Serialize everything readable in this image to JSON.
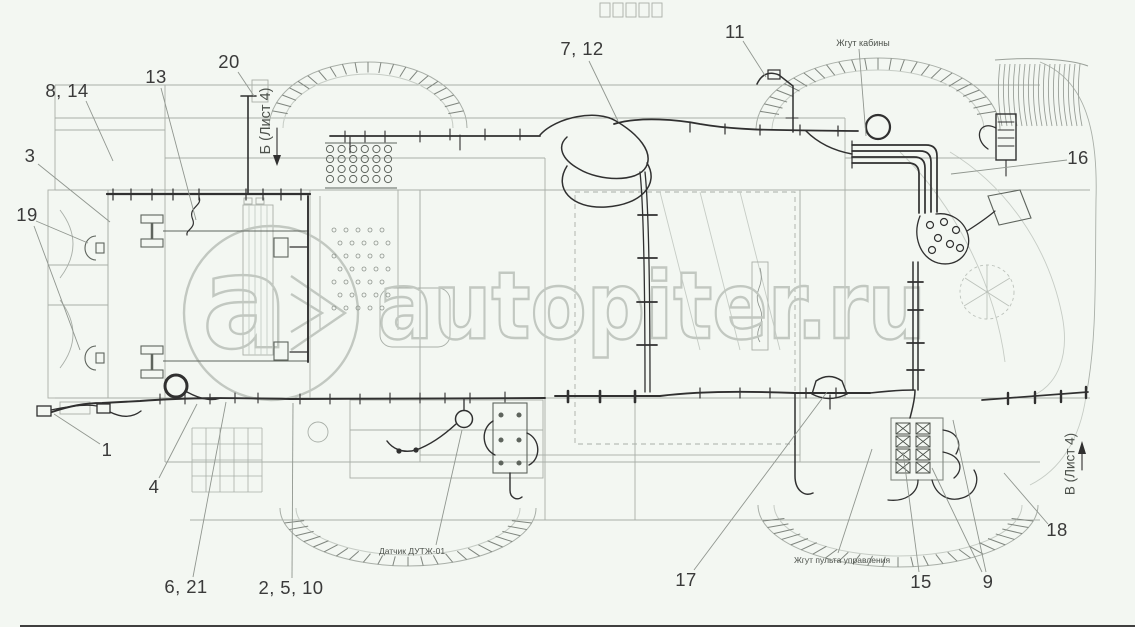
{
  "page": {
    "background": "#f3f7f2",
    "bottom_rule_color": "#3f3f3f"
  },
  "watermark": {
    "logo_letter": "a",
    "text": "autopiter.ru",
    "color": "#c2c8c1"
  },
  "drawing": {
    "dark_line_color": "#303030",
    "light_line_color": "#a9afa8",
    "leader_color": "#90968f",
    "callout_color": "#3a3a3a",
    "callouts": [
      {
        "label": "8, 14",
        "x": 67,
        "y": 91,
        "leaders": [
          [
            86,
            101,
            113,
            161
          ]
        ]
      },
      {
        "label": "13",
        "x": 156,
        "y": 77,
        "leaders": [
          [
            161,
            88,
            196,
            220
          ]
        ]
      },
      {
        "label": "20",
        "x": 229,
        "y": 62,
        "leaders": [
          [
            238,
            72,
            254,
            96
          ]
        ]
      },
      {
        "label": "3",
        "x": 30,
        "y": 156,
        "leaders": [
          [
            38,
            164,
            110,
            222
          ]
        ]
      },
      {
        "label": "19",
        "x": 27,
        "y": 215,
        "leaders": [
          [
            36,
            221,
            88,
            243
          ],
          [
            34,
            226,
            80,
            350
          ]
        ]
      },
      {
        "label": "1",
        "x": 107,
        "y": 450,
        "leaders": [
          [
            100,
            444,
            54,
            414
          ]
        ]
      },
      {
        "label": "4",
        "x": 154,
        "y": 487,
        "leaders": [
          [
            159,
            478,
            197,
            404
          ]
        ]
      },
      {
        "label": "6, 21",
        "x": 186,
        "y": 587,
        "leaders": [
          [
            193,
            577,
            226,
            402
          ]
        ]
      },
      {
        "label": "2, 5, 10",
        "x": 291,
        "y": 588,
        "leaders": [
          [
            292,
            578,
            293,
            403
          ]
        ]
      },
      {
        "label": "7, 12",
        "x": 582,
        "y": 49,
        "leaders": [
          [
            589,
            61,
            618,
            121
          ]
        ]
      },
      {
        "label": "11",
        "x": 735,
        "y": 32,
        "leaders": [
          [
            743,
            41,
            766,
            77
          ]
        ]
      },
      {
        "label": "16",
        "x": 1078,
        "y": 158,
        "leaders": [
          [
            1067,
            160,
            951,
            174
          ]
        ]
      },
      {
        "label": "17",
        "x": 686,
        "y": 580,
        "leaders": [
          [
            694,
            570,
            827,
            392
          ]
        ]
      },
      {
        "label": "15",
        "x": 921,
        "y": 582,
        "leaders": [
          [
            919,
            572,
            903,
            452
          ]
        ]
      },
      {
        "label": "9",
        "x": 988,
        "y": 582,
        "leaders": [
          [
            982,
            572,
            932,
            468
          ],
          [
            986,
            572,
            953,
            420
          ]
        ]
      },
      {
        "label": "18",
        "x": 1057,
        "y": 530,
        "leaders": [
          [
            1048,
            524,
            1004,
            473
          ]
        ]
      }
    ],
    "labels": [
      {
        "text": "Жгут кабины",
        "x": 863,
        "y": 43,
        "rotate": 0,
        "size": 9,
        "leaders": [
          [
            859,
            49,
            866,
            136
          ]
        ]
      },
      {
        "text": "Датчик ДУТЖ-01",
        "x": 412,
        "y": 551,
        "rotate": 0,
        "size": 8.5,
        "leaders": [
          [
            436,
            545,
            462,
            430
          ]
        ]
      },
      {
        "text": "Жгут пульта управления",
        "x": 842,
        "y": 560,
        "rotate": 0,
        "size": 8.5,
        "leaders": [
          [
            838,
            553,
            872,
            449
          ]
        ]
      },
      {
        "text": "Б (Лист 4)",
        "x": 266,
        "y": 121,
        "rotate": -90,
        "size": 14.5,
        "leaders": []
      },
      {
        "text": "В (Лист 4)",
        "x": 1070,
        "y": 464,
        "rotate": -90,
        "size": 13.5,
        "leaders": []
      }
    ]
  }
}
